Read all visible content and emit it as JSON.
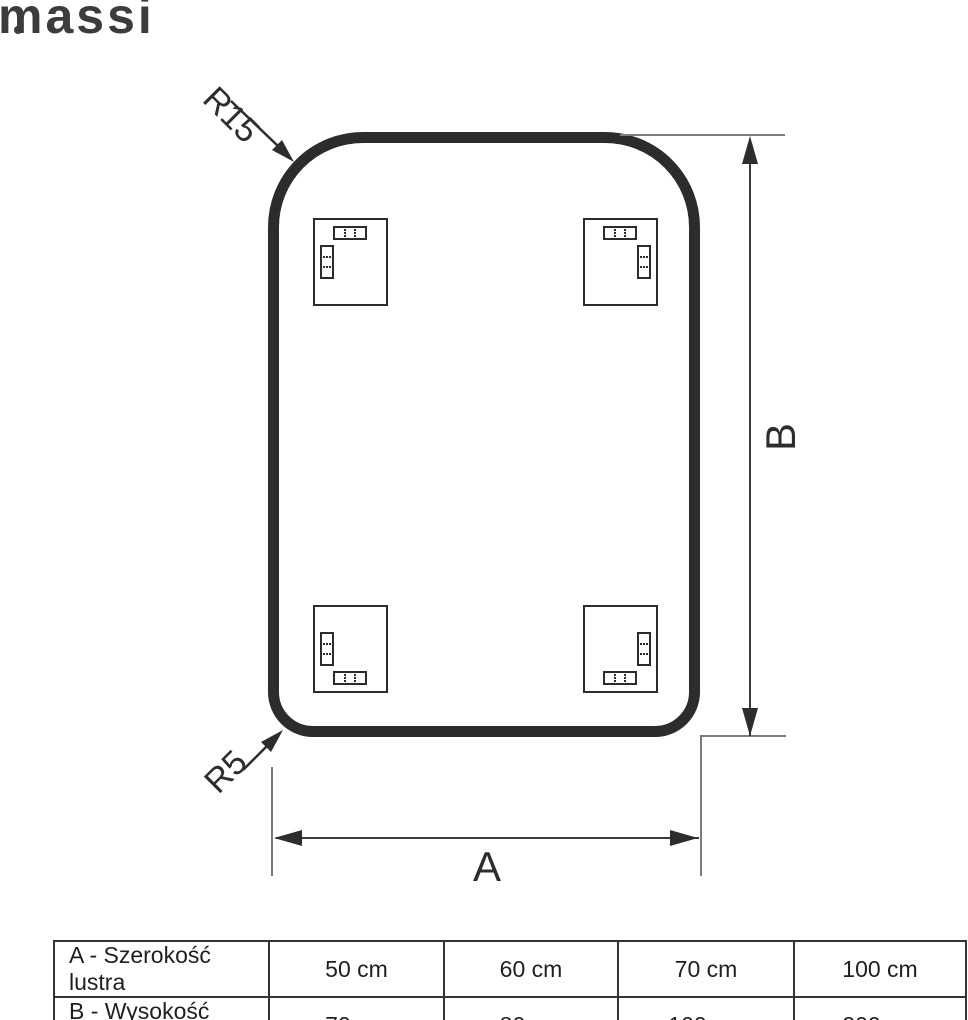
{
  "brand": {
    "logo_text": "massi"
  },
  "diagram": {
    "radius_top_label": "R15",
    "radius_bottom_label": "R5",
    "width_label": "A",
    "height_label": "B",
    "stroke_color": "#2c2c2c"
  },
  "table": {
    "rows": [
      {
        "label": "A - Szerokość lustra",
        "values": [
          "50 cm",
          "60 cm",
          "70 cm",
          "100 cm"
        ]
      },
      {
        "label": "B - Wysokość lustra",
        "values": [
          "70 cm",
          "80 cm",
          "100 cm",
          "200 cm"
        ]
      }
    ]
  }
}
